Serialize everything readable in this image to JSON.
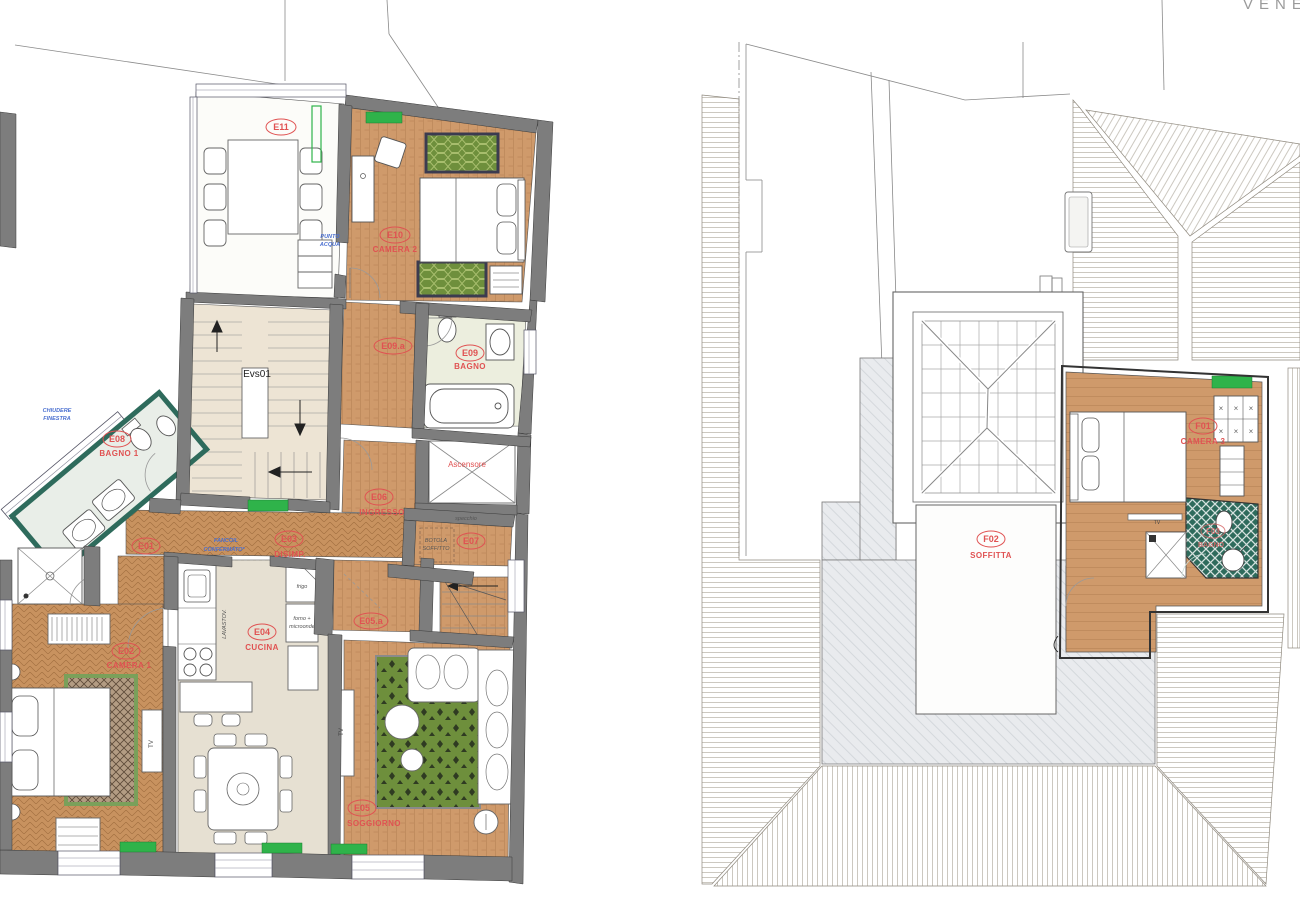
{
  "document": {
    "location_header": "VENEZIA"
  },
  "colors": {
    "label_red": "#e05252",
    "annotation_blue": "#4a6fd0",
    "wall_gray": "#7d7d7d",
    "wood_tan": "#cf9a6b",
    "rug_green": "#6e8f3c",
    "radiator_green": "#2fb34a",
    "bath_teal": "#2e6b5c",
    "roof_gray": "#e9ebee"
  },
  "floor_plan_left": {
    "rooms": {
      "e11": {
        "code": "E11",
        "name": ""
      },
      "e10": {
        "code": "E10",
        "name": "CAMERA 2"
      },
      "e09a": {
        "code": "E09.a",
        "name": ""
      },
      "e09": {
        "code": "E09",
        "name": "BAGNO"
      },
      "e08": {
        "code": "E08",
        "name": "BAGNO 1"
      },
      "e07": {
        "code": "E07",
        "name": ""
      },
      "e06": {
        "code": "E06",
        "name": "INGRESSO"
      },
      "e05a": {
        "code": "E05.a",
        "name": ""
      },
      "e05": {
        "code": "E05",
        "name": "SOGGIORNO"
      },
      "e04": {
        "code": "E04",
        "name": "CUCINA"
      },
      "e03": {
        "code": "E03",
        "name": "DISIMP."
      },
      "e02": {
        "code": "E02",
        "name": "CAMERA 1"
      },
      "e01": {
        "code": "E01",
        "name": ""
      }
    },
    "stairwell_label": "Evs01",
    "elevator_label": "Ascensore",
    "hatch_label_line1": "BOTOLA",
    "hatch_label_line2": "SOFFITTO",
    "annotations": {
      "chiudere_line1": "CHIUDERE",
      "chiudere_line2": "FINESTRA",
      "fancoil_line1": "FANCOIL",
      "fancoil_line2": "CONFERMATO*",
      "punto_line1": "PUNTO",
      "punto_line2": "ACQUA",
      "specchio": "specchio"
    },
    "appliances": {
      "frigo": "frigo",
      "forno_line1": "forno +",
      "forno_line2": "microonde",
      "lavastoviglie": "LAVASTOV.",
      "tv_camera1": "TV",
      "tv_soggiorno": "TV"
    }
  },
  "floor_plan_right": {
    "rooms": {
      "f01": {
        "code": "F01",
        "name": "CAMERA 3"
      },
      "f02": {
        "code": "F02",
        "name": "SOFFITTA"
      },
      "f03": {
        "code": "F03",
        "name": "BAGNO"
      }
    },
    "appliances": {
      "tv_camera3": "TV"
    }
  }
}
